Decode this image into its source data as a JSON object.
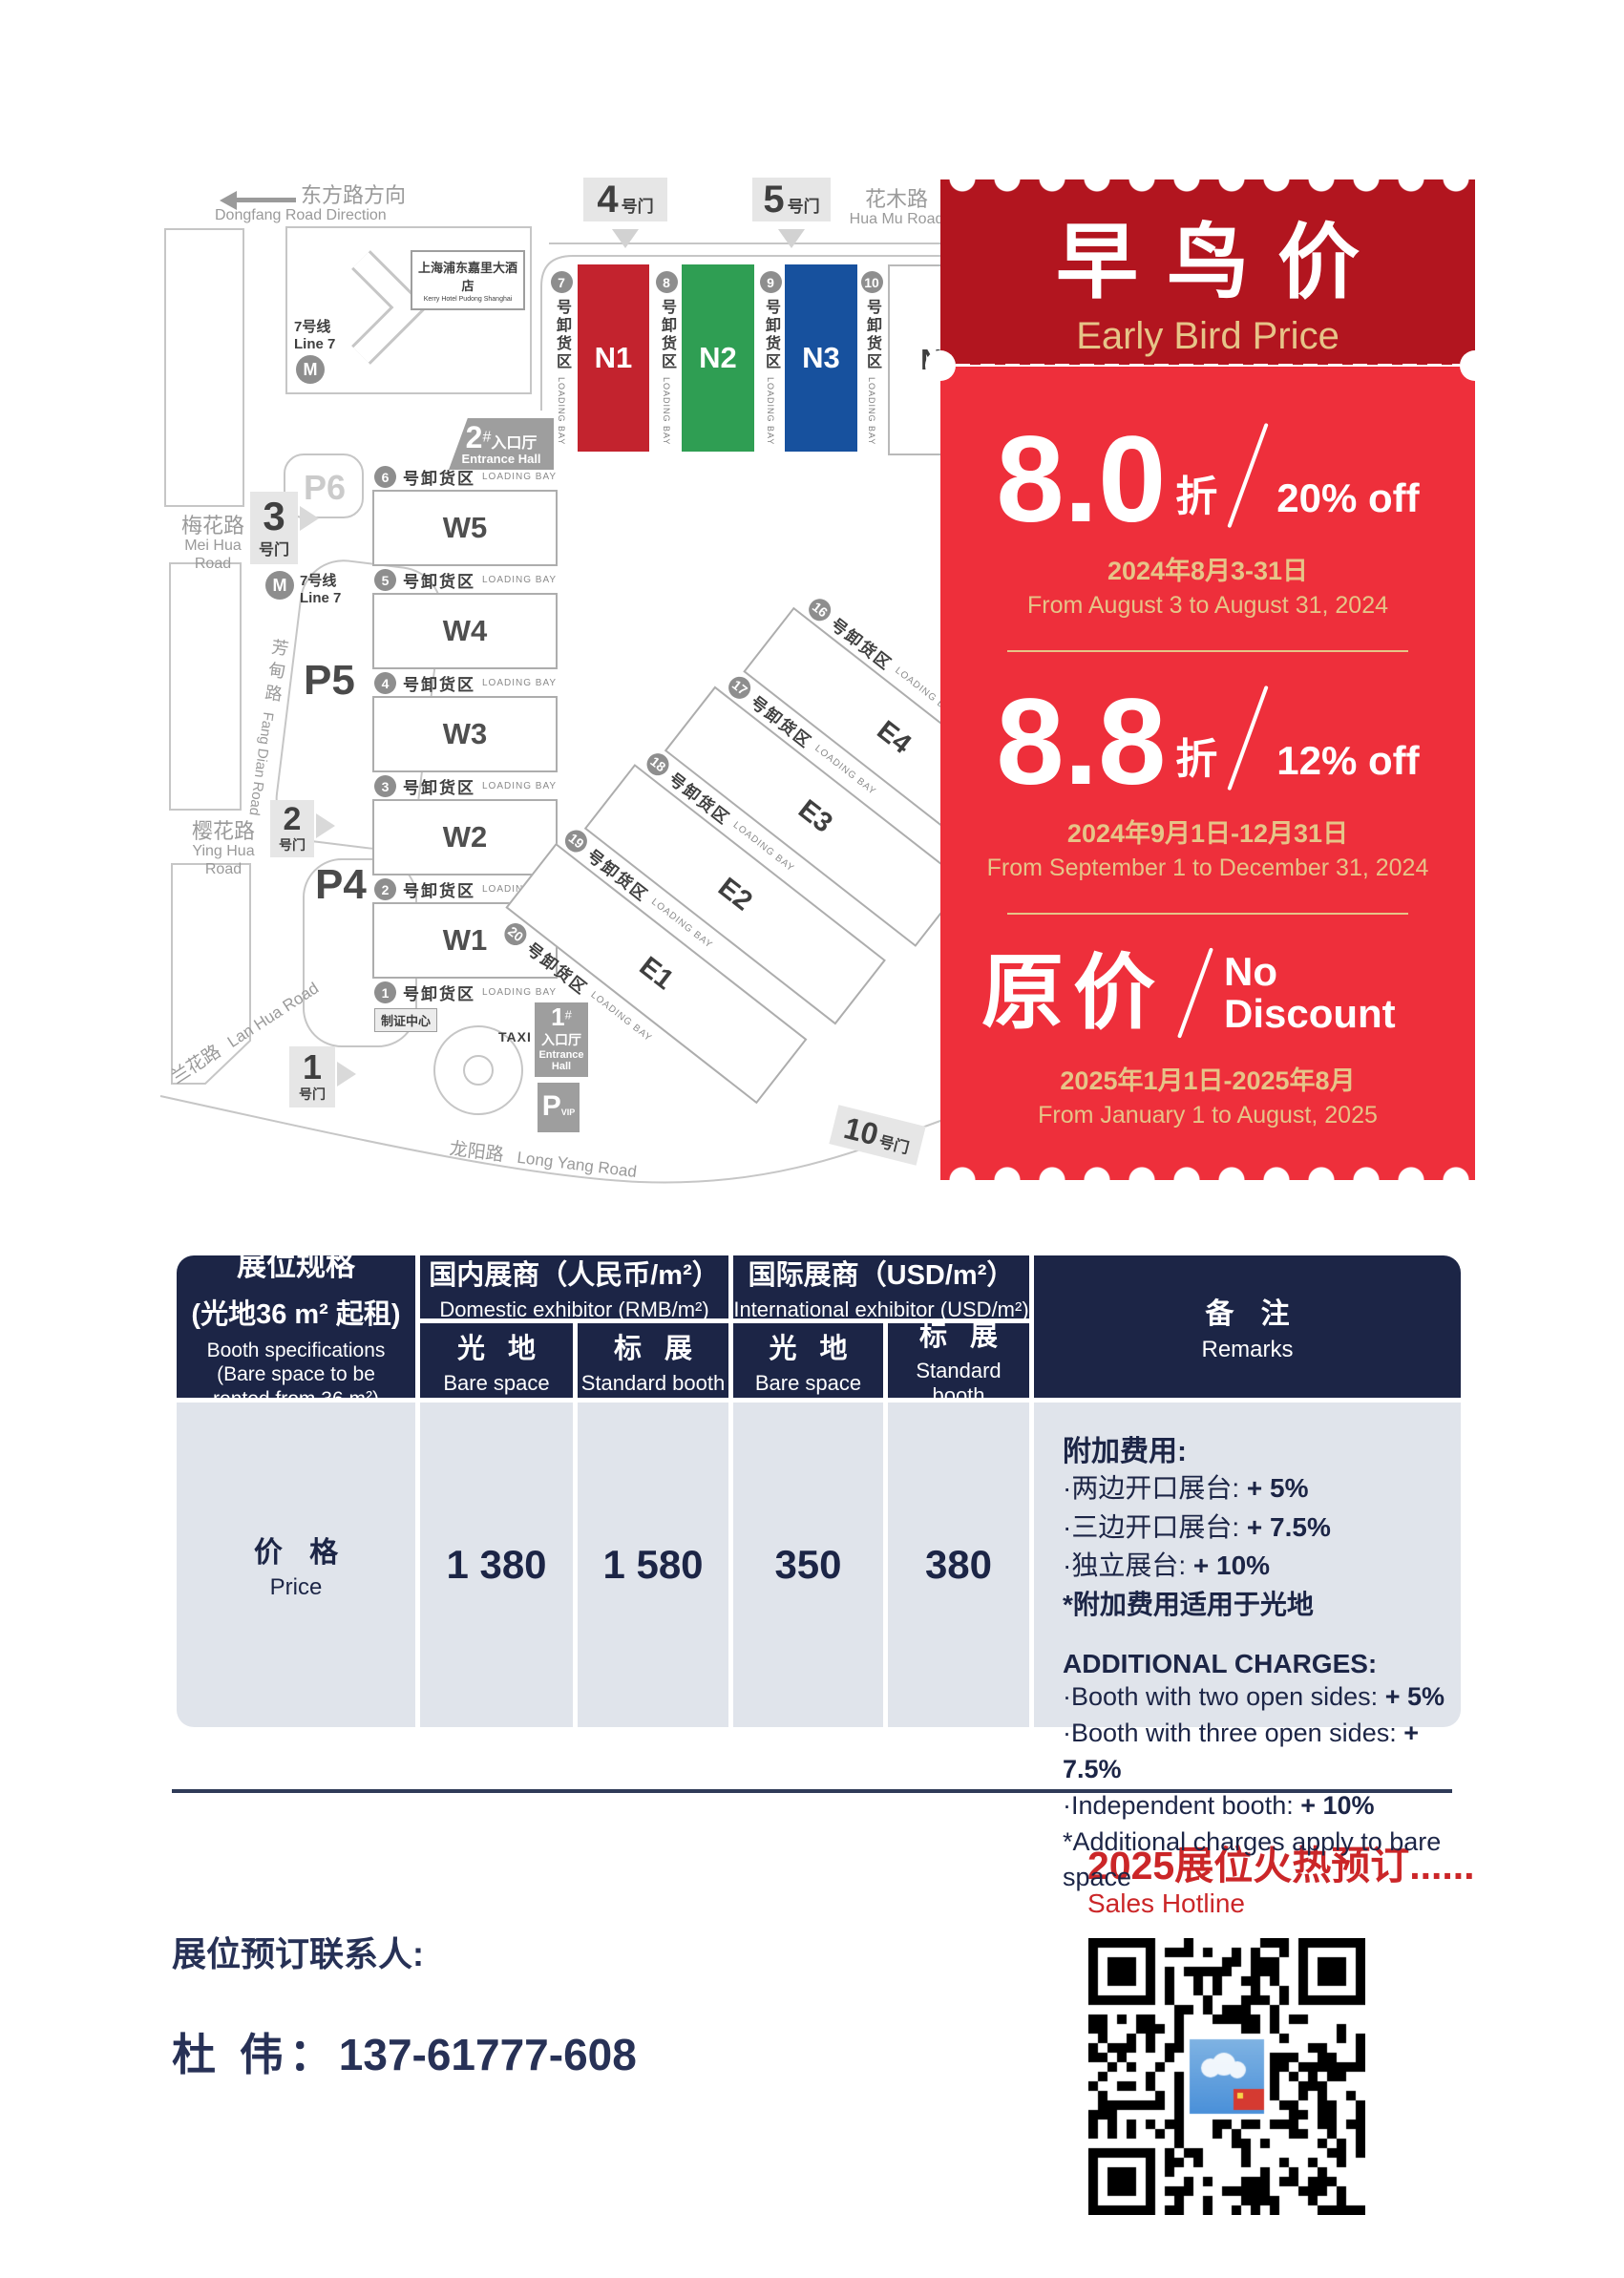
{
  "map": {
    "direction": {
      "zh": "东方路方向",
      "en": "Dongfang Road Direction"
    },
    "gate_suffix": "号门",
    "gates": {
      "g1": "1",
      "g2": "2",
      "g3": "3",
      "g4": "4",
      "g5": "5",
      "g10": "10"
    },
    "roads": {
      "huamu_zh": "花木路",
      "huamu_en": "Hua Mu Road",
      "meihua_zh": "梅花路",
      "meihua_en": "Mei Hua Road",
      "yinghua_zh": "樱花路",
      "yinghua_en": "Ying Hua Road",
      "lanhua_zh": "兰花路",
      "lanhua_en": "Lan Hua Road",
      "fangdian_zh": "芳甸路",
      "fangdian_en": "Fang Dian Road",
      "longyang_zh": "龙阳路",
      "longyang_en": "Long Yang Road"
    },
    "metro": {
      "zh": "7号线",
      "en": "Line 7"
    },
    "hotel": {
      "zh": "上海浦东嘉里大酒店",
      "en": "Kerry Hotel Pudong Shanghai"
    },
    "entrance2": {
      "num": "2",
      "sup": "#",
      "zh": "入口厅",
      "en": "Entrance Hall"
    },
    "entrance1": {
      "num": "1",
      "sup": "#",
      "zh": "入口厅",
      "en": "Entrance Hall"
    },
    "credential": "制证中心",
    "taxi": "TAXI",
    "parking": {
      "p6": "P6",
      "p5": "P5",
      "p4": "P4",
      "pvip": "P",
      "vip": "VIP"
    },
    "bay_zh": "号卸货区",
    "bay_en": "LOADING BAY",
    "n_bays": [
      "7",
      "8",
      "9",
      "10"
    ],
    "n_halls": [
      {
        "label": "N1",
        "color": "#C3232E",
        "text": "#FFFFFF"
      },
      {
        "label": "N2",
        "color": "#2F9E53",
        "text": "#FFFFFF"
      },
      {
        "label": "N3",
        "color": "#17519E",
        "text": "#FFFFFF"
      },
      {
        "label": "N4",
        "color": "#FFFFFF",
        "text": "#3F3F3F",
        "border": "#B9B9B9"
      }
    ],
    "w_bays": [
      "6",
      "5",
      "4",
      "3",
      "2",
      "1"
    ],
    "w_halls": [
      "W5",
      "W4",
      "W3",
      "W2",
      "W1"
    ],
    "e_bays": [
      "16",
      "17",
      "18",
      "19",
      "20"
    ],
    "e_halls": [
      "E4",
      "E3",
      "E2",
      "E1"
    ]
  },
  "ticket": {
    "title_zh": "早鸟价",
    "title_en": "Early Bird Price",
    "colors": {
      "header": "#B2151F",
      "body": "#EE2F3B",
      "gold": "#E6C488"
    },
    "tiers": [
      {
        "big": "8.0",
        "unit": "折",
        "pct": "20% off",
        "date_zh": "2024年8月3-31日",
        "date_en": "From August 3 to August 31, 2024"
      },
      {
        "big": "8.8",
        "unit": "折",
        "pct": "12% off",
        "date_zh": "2024年9月1日-12月31日",
        "date_en": "From September 1 to December 31, 2024"
      },
      {
        "big": "原价",
        "unit": "",
        "pct": "No Discount",
        "date_zh": "2025年1月1日-2025年8月",
        "date_en": "From January 1 to August, 2025"
      }
    ]
  },
  "table": {
    "col1": {
      "zh1": "展位规格",
      "zh2": "(光地36 m² 起租)",
      "en1": "Booth specifications",
      "en2": "(Bare space to be rented from 36 m²)"
    },
    "groups": [
      {
        "zh": "国内展商（人民币/m²）",
        "en": "Domestic exhibitor (RMB/m²)"
      },
      {
        "zh": "国际展商（USD/m²）",
        "en": "International exhibitor (USD/m²)"
      }
    ],
    "subs": [
      {
        "zh": "光 地",
        "en": "Bare space"
      },
      {
        "zh": "标 展",
        "en": "Standard booth"
      },
      {
        "zh": "光 地",
        "en": "Bare space"
      },
      {
        "zh": "标 展",
        "en": "Standard booth"
      }
    ],
    "remarks_header": {
      "zh": "备 注",
      "en": "Remarks"
    },
    "row_label": {
      "zh": "价 格",
      "en": "Price"
    },
    "prices": [
      "1 380",
      "1 580",
      "350",
      "380"
    ],
    "remarks_zh": {
      "title": "附加费用:",
      "lines": [
        {
          "pre": "·两边开口展台: ",
          "bold": "+ 5%"
        },
        {
          "pre": "·三边开口展台: ",
          "bold": "+ 7.5%"
        },
        {
          "pre": "·独立展台: ",
          "bold": "+ 10%"
        }
      ],
      "note": "*附加费用适用于光地"
    },
    "remarks_en": {
      "title": "ADDITIONAL CHARGES:",
      "lines": [
        {
          "pre": "·Booth with two open sides: ",
          "bold": "+ 5%"
        },
        {
          "pre": "·Booth with three open sides: ",
          "bold": "+ 7.5%"
        },
        {
          "pre": "·Independent booth: ",
          "bold": "+ 10%"
        }
      ],
      "note": "*Additional charges apply to bare space"
    },
    "colors": {
      "navy": "#1C2546",
      "light": "#E0E4EB"
    }
  },
  "footer": {
    "hot_title": "2025展位火热预订......",
    "hot_sub": "Sales Hotline",
    "contact_label": "展位预订联系人:",
    "contact_name": "杜  伟：",
    "contact_phone": "137-61777-608",
    "accent": "#CB2628",
    "navy": "#273156"
  }
}
